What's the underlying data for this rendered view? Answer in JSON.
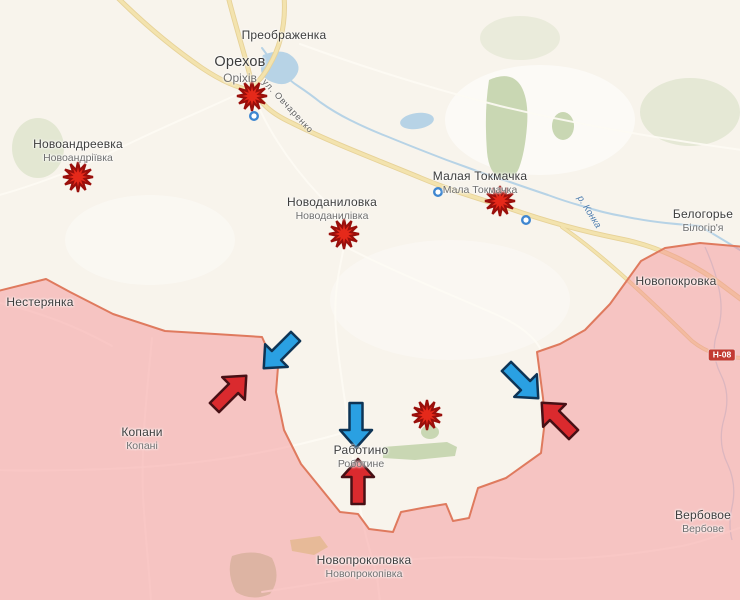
{
  "colors": {
    "bg": "#f8f4ec",
    "field": "#ffffff",
    "green": "#c9d7b3",
    "green-bright": "#dde2a0",
    "river": "#b7d3e6",
    "road-minor": "#fdfbf4",
    "road-major": "#f3e3ae",
    "road-major-casing": "#e7d298",
    "occupied-fill": "rgba(244,140,143,0.46)",
    "frontline": "#df7a5e",
    "label": "#3d3d3d",
    "label-alt": "#6f6f6f",
    "street-label": "#5f5f5f",
    "river-label": "#4d7cad",
    "shield-bg": "#c23a31",
    "shield-text": "#ffffff",
    "explosion": "#e5291a",
    "explosion-stroke": "#9a0f0b",
    "arrow-blue": "#2aa0e2",
    "arrow-blue-stroke": "#0e3455",
    "arrow-red": "#da2a2e",
    "arrow-red-stroke": "#471015",
    "marker-ring": "#3e86d0"
  },
  "settlements": [
    {
      "name": "Преображенка",
      "alt": "",
      "x": 284,
      "y": 36,
      "large": false
    },
    {
      "name": "Орехов",
      "alt": "Оріхів",
      "x": 240,
      "y": 64,
      "large": true
    },
    {
      "name": "Новоандреевка",
      "alt": "Новоандріївка",
      "x": 78,
      "y": 145,
      "large": false
    },
    {
      "name": "Новоданиловка",
      "alt": "Новоданилівка",
      "x": 332,
      "y": 203,
      "large": false
    },
    {
      "name": "Малая Токмачка",
      "alt": "Мала Токмачка",
      "x": 480,
      "y": 177,
      "large": false
    },
    {
      "name": "Белогорье",
      "alt": "Білогір'я",
      "x": 703,
      "y": 215,
      "large": false
    },
    {
      "name": "Нестерянка",
      "alt": "",
      "x": 40,
      "y": 303,
      "large": false
    },
    {
      "name": "Новопокровка",
      "alt": "",
      "x": 676,
      "y": 282,
      "large": false
    },
    {
      "name": "Копани",
      "alt": "Копані",
      "x": 142,
      "y": 433,
      "large": false
    },
    {
      "name": "Работино",
      "alt": "Роботине",
      "x": 361,
      "y": 451,
      "large": false
    },
    {
      "name": "Вербовое",
      "alt": "Вербове",
      "x": 703,
      "y": 516,
      "large": false
    },
    {
      "name": "Новопрокоповка",
      "alt": "Новопрокопівка",
      "x": 364,
      "y": 561,
      "large": false
    }
  ],
  "street_label": {
    "text": "ул. Овчаренко",
    "x": 288,
    "y": 106,
    "rotation": 47
  },
  "river_label": {
    "text": "р. Конка",
    "x": 589,
    "y": 212,
    "rotation": 58
  },
  "road_shield": {
    "text": "Н-08",
    "x": 722,
    "y": 355
  },
  "explosions": [
    {
      "x": 252,
      "y": 96
    },
    {
      "x": 78,
      "y": 177
    },
    {
      "x": 344,
      "y": 234
    },
    {
      "x": 500,
      "y": 201
    },
    {
      "x": 427,
      "y": 415
    }
  ],
  "location_markers": [
    {
      "x": 254,
      "y": 116
    },
    {
      "x": 438,
      "y": 192
    },
    {
      "x": 526,
      "y": 220
    }
  ],
  "arrows": [
    {
      "color": "blue",
      "direction": "south",
      "x": 356,
      "y": 425,
      "rot": 0
    },
    {
      "color": "red",
      "direction": "north",
      "x": 358,
      "y": 482,
      "rot": 180
    },
    {
      "color": "blue",
      "direction": "southwest",
      "x": 280,
      "y": 352,
      "rot": 45
    },
    {
      "color": "red",
      "direction": "northeast",
      "x": 230,
      "y": 392,
      "rot": 225
    },
    {
      "color": "blue",
      "direction": "southeast",
      "x": 522,
      "y": 382,
      "rot": 315
    },
    {
      "color": "red",
      "direction": "northwest",
      "x": 558,
      "y": 419,
      "rot": 135
    }
  ]
}
